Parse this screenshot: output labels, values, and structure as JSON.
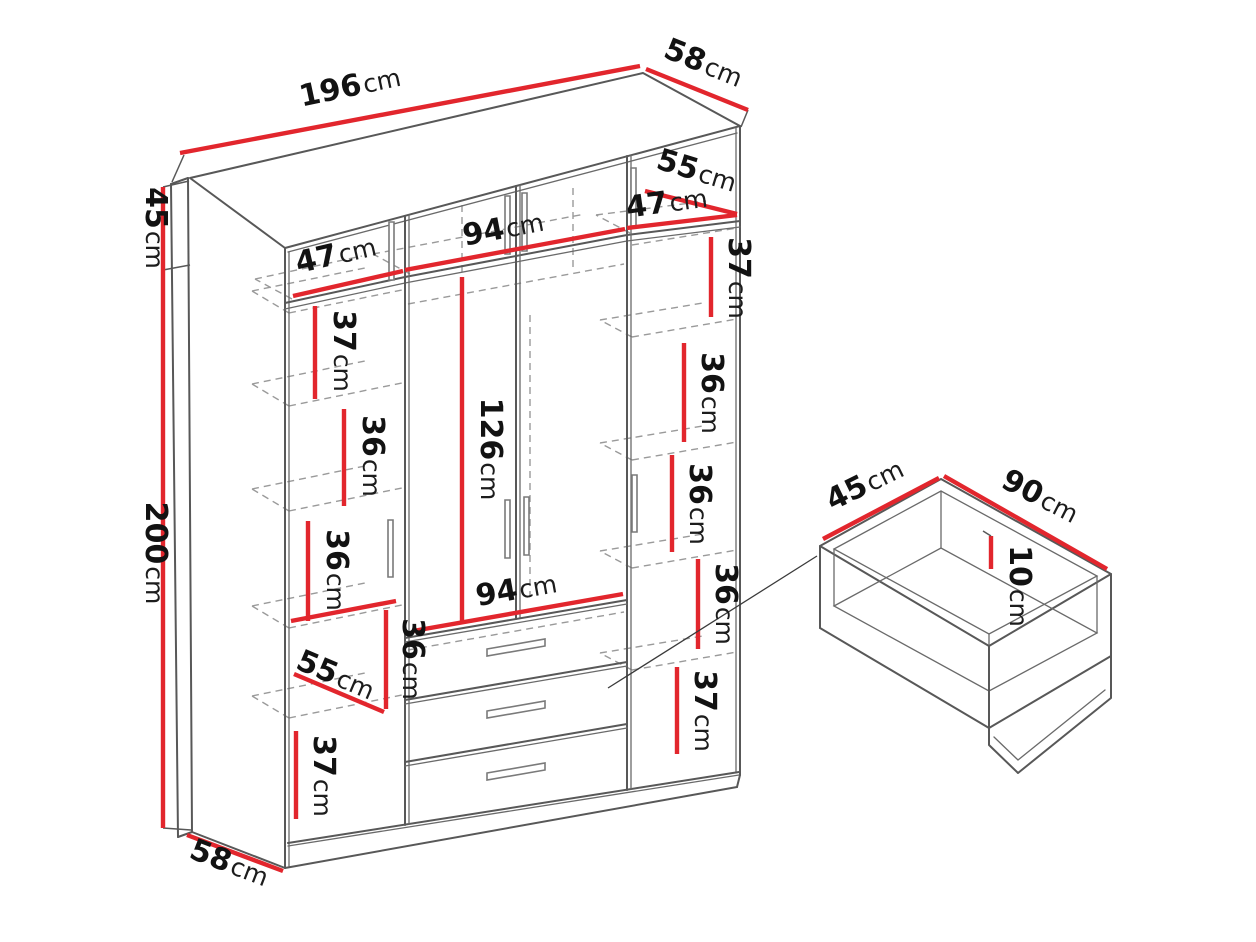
{
  "page": {
    "background": "#ffffff"
  },
  "colors": {
    "dimension_line": "#e2262d",
    "outline": "#585858",
    "hidden_line": "#9a9a9a",
    "label": "#121212"
  },
  "wardrobe": {
    "overall": {
      "width": {
        "v": "196",
        "u": "cm"
      },
      "depth_top": {
        "v": "58",
        "u": "cm"
      },
      "upper_height": {
        "v": "45",
        "u": "cm"
      },
      "body_height": {
        "v": "200",
        "u": "cm"
      },
      "depth_bottom": {
        "v": "58",
        "u": "cm"
      }
    },
    "top_cabinet": {
      "left_width": {
        "v": "47",
        "u": "cm"
      },
      "middle_width": {
        "v": "94",
        "u": "cm"
      },
      "right_width": {
        "v": "47",
        "u": "cm"
      },
      "interior_depth": {
        "v": "55",
        "u": "cm"
      }
    },
    "left_column": {
      "shelf_1": {
        "v": "37",
        "u": "cm"
      },
      "shelf_2": {
        "v": "36",
        "u": "cm"
      },
      "shelf_3": {
        "v": "36",
        "u": "cm"
      },
      "compartment_height": {
        "v": "36",
        "u": "cm"
      },
      "compartment_width": {
        "v": "55",
        "u": "cm"
      },
      "shelf_bottom": {
        "v": "37",
        "u": "cm"
      }
    },
    "middle_section": {
      "door_height": {
        "v": "126",
        "u": "cm"
      },
      "width": {
        "v": "94",
        "u": "cm"
      }
    },
    "right_column": {
      "shelf_1": {
        "v": "37",
        "u": "cm"
      },
      "shelf_2": {
        "v": "36",
        "u": "cm"
      },
      "shelf_3": {
        "v": "36",
        "u": "cm"
      },
      "shelf_4": {
        "v": "36",
        "u": "cm"
      },
      "shelf_5": {
        "v": "37",
        "u": "cm"
      }
    }
  },
  "drawer_detail": {
    "width": {
      "v": "45",
      "u": "cm"
    },
    "length": {
      "v": "90",
      "u": "cm"
    },
    "height": {
      "v": "10",
      "u": "cm"
    }
  }
}
